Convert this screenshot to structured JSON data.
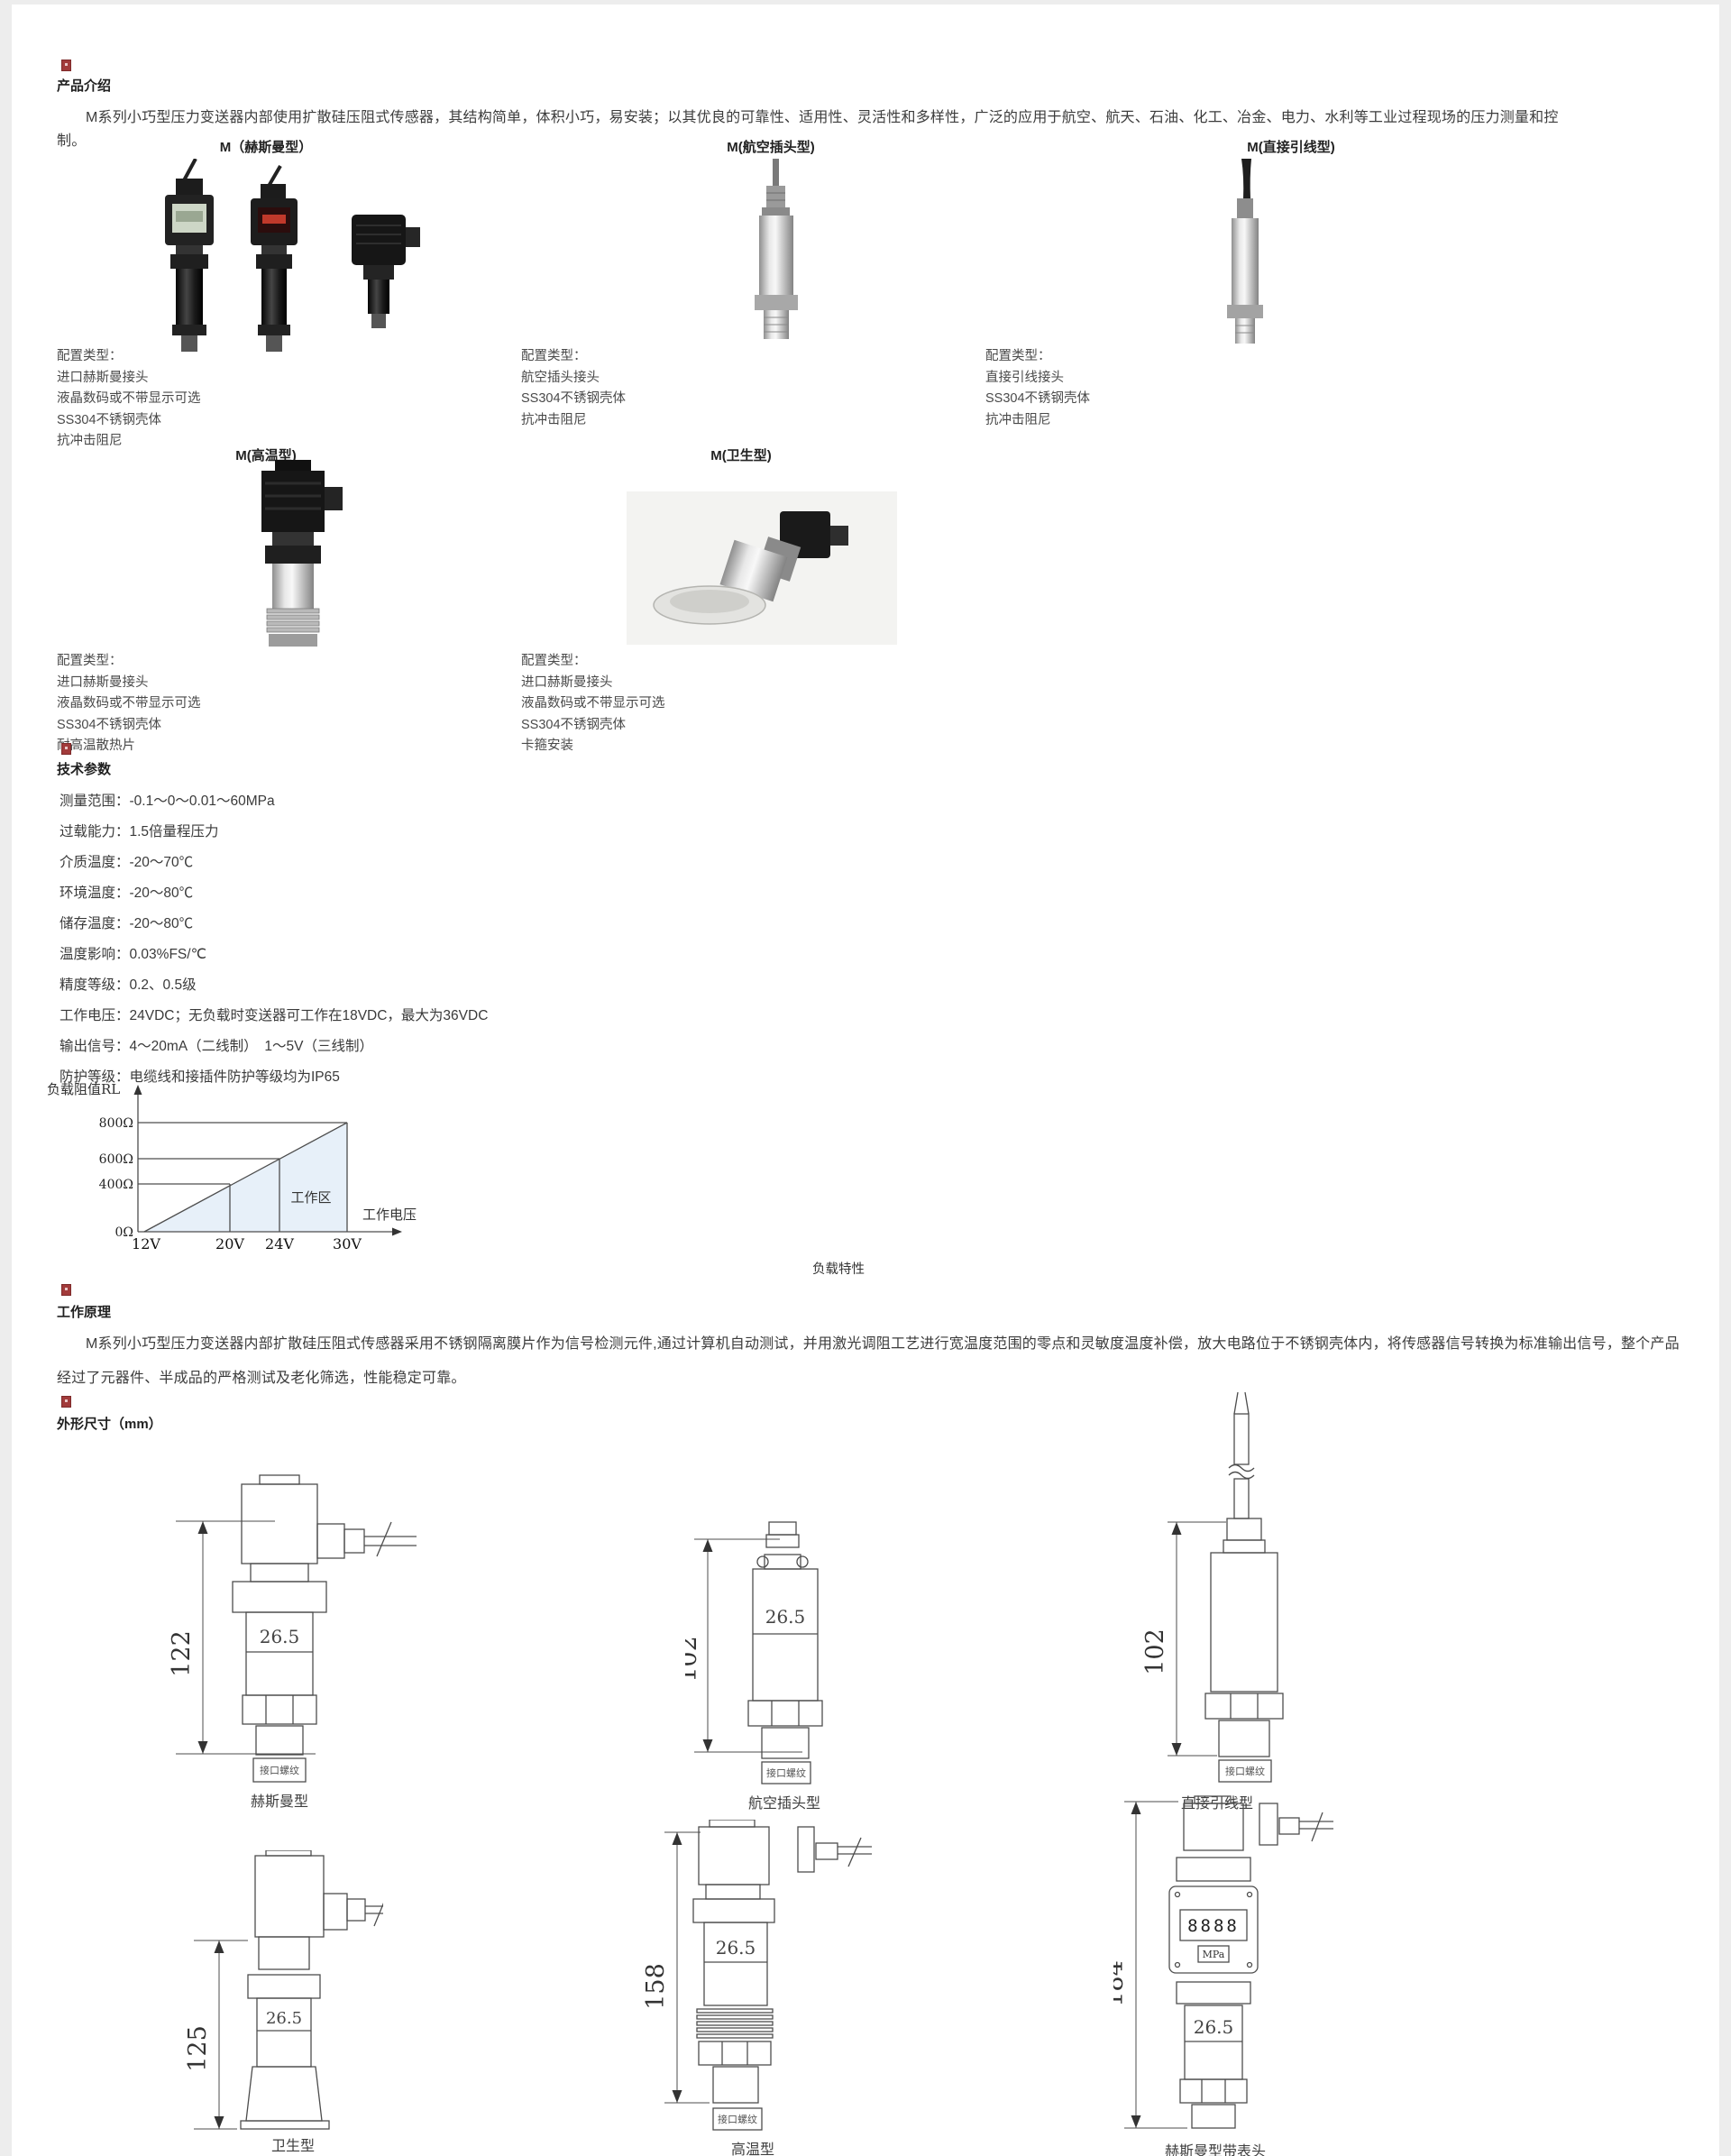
{
  "intro": {
    "heading": "产品介绍",
    "paragraph": "M系列小巧型压力变送器内部使用扩散硅压阻式传感器，其结构简单，体积小巧，易安装；以其优良的可靠性、适用性、灵活性和多样性，广泛的应用于航空、航天、石油、化工、冶金、电力、水利等工业过程现场的压力测量和控制。"
  },
  "variants": {
    "config_label": "配置类型：",
    "row1": [
      {
        "title": "M（赫斯曼型）",
        "features": [
          "进口赫斯曼接头",
          "液晶数码或不带显示可选",
          "SS304不锈钢壳体",
          "抗冲击阻尼"
        ]
      },
      {
        "title": "M(航空插头型)",
        "features": [
          "航空插头接头",
          "SS304不锈钢壳体",
          "抗冲击阻尼"
        ]
      },
      {
        "title": "M(直接引线型)",
        "features": [
          "直接引线接头",
          "SS304不锈钢壳体",
          "抗冲击阻尼"
        ]
      }
    ],
    "row2": [
      {
        "title": "M(高温型)",
        "features": [
          "进口赫斯曼接头",
          "液晶数码或不带显示可选",
          "SS304不锈钢壳体",
          "耐高温散热片"
        ]
      },
      {
        "title": "M(卫生型)",
        "features": [
          "进口赫斯曼接头",
          "液晶数码或不带显示可选",
          "SS304不锈钢壳体",
          "卡箍安装"
        ]
      }
    ]
  },
  "tech": {
    "heading": "技术参数",
    "items": [
      "测量范围：-0.1～0～0.01～60MPa",
      "过载能力：1.5倍量程压力",
      "介质温度：-20～70℃",
      "环境温度：-20～80℃",
      "储存温度：-20～80℃",
      "温度影响：0.03%FS/℃",
      "精度等级：0.2、0.5级",
      "工作电压：24VDC；无负载时变送器可工作在18VDC，最大为36VDC",
      "输出信号：4～20mA（二线制）　1～5V（三线制）",
      "防护等级：电缆线和接插件防护等级均为IP65"
    ]
  },
  "chart": {
    "y_axis_label": "负载阻值RL",
    "x_axis_label": "工作电压",
    "region_label": "工作区",
    "caption": "负载特性",
    "y_ticks": [
      "800Ω",
      "600Ω",
      "400Ω",
      "0Ω"
    ],
    "x_ticks": [
      "12V",
      "20V",
      "24V",
      "30V"
    ]
  },
  "chart_data": {
    "type": "line",
    "title": "负载特性",
    "xlabel": "工作电压",
    "ylabel": "负载阻值RL",
    "x": [
      12,
      20,
      24,
      30
    ],
    "x_tick_labels": [
      "12V",
      "20V",
      "24V",
      "30V"
    ],
    "y_ticks": [
      0,
      400,
      600,
      800
    ],
    "y_tick_labels": [
      "0Ω",
      "400Ω",
      "600Ω",
      "800Ω"
    ],
    "series": [
      {
        "name": "负载阻值上限RL",
        "points": [
          [
            12,
            0
          ],
          [
            20,
            400
          ],
          [
            24,
            600
          ],
          [
            30,
            800
          ]
        ]
      }
    ],
    "region_label": "工作区",
    "legend": false,
    "grid": false
  },
  "principle": {
    "heading": "工作原理",
    "paragraph": "M系列小巧型压力变送器内部扩散硅压阻式传感器采用不锈钢隔离膜片作为信号检测元件,通过计算机自动测试，并用激光调阻工艺进行宽温度范围的零点和灵敏度温度补偿，放大电路位于不锈钢壳体内，将传感器信号转换为标准输出信号，整个产品经过了元器件、半成品的严格测试及老化筛选，性能稳定可靠。"
  },
  "dims": {
    "heading": "外形尺寸（mm）",
    "drawings": [
      {
        "caption": "赫斯曼型",
        "height": "122",
        "width": "26.5",
        "thread": "接口螺纹"
      },
      {
        "caption": "航空插头型",
        "height": "102",
        "width": "26.5",
        "thread": "接口螺纹"
      },
      {
        "caption": "直接引线型",
        "height": "102",
        "thread": "接口螺纹"
      },
      {
        "caption": "卫生型",
        "height": "125",
        "width": "26.5"
      },
      {
        "caption": "高温型",
        "height": "158",
        "width": "26.5",
        "thread": "接口螺纹"
      },
      {
        "caption": "赫斯曼型带表头",
        "height": "184",
        "width": "26.5",
        "display": "8888",
        "unit": "MPa"
      }
    ]
  }
}
